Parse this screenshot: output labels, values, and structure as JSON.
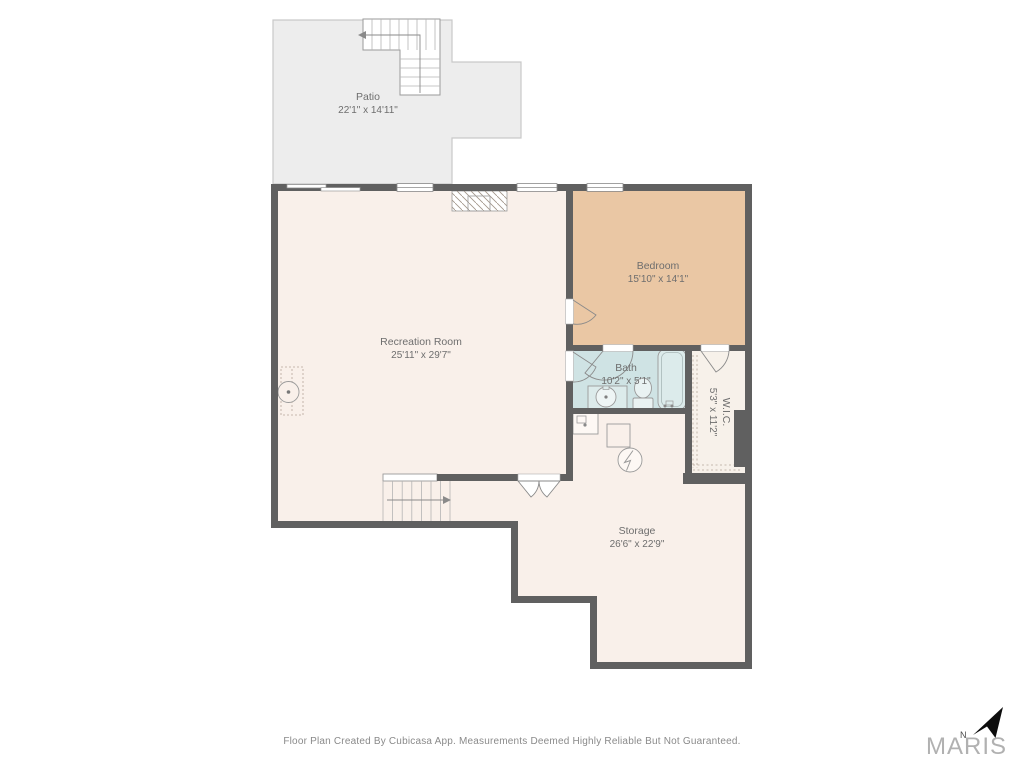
{
  "rooms": {
    "patio": {
      "name": "Patio",
      "dims": "22'1\" x 14'11\""
    },
    "recreation": {
      "name": "Recreation Room",
      "dims": "25'11\" x 29'7\""
    },
    "bedroom": {
      "name": "Bedroom",
      "dims": "15'10\" x 14'1\""
    },
    "bath": {
      "name": "Bath",
      "dims": "10'2\" x 5'1\""
    },
    "wic": {
      "name": "W.I.C.",
      "dims": "5'3\" x 11'2\""
    },
    "storage": {
      "name": "Storage",
      "dims": "26'6\" x 22'9\""
    }
  },
  "footer": {
    "disclaimer": "Floor Plan Created By Cubicasa App. Measurements Deemed Highly Reliable But Not Guaranteed."
  },
  "logo": {
    "brand": "MARIS",
    "north": "N"
  },
  "colors": {
    "wall": "#606060",
    "floor": "#f9f0ea",
    "bedroom": "#eac7a4",
    "bath": "#cfe3e4",
    "wic": "#f7f1ea",
    "patio": "#ededed"
  }
}
